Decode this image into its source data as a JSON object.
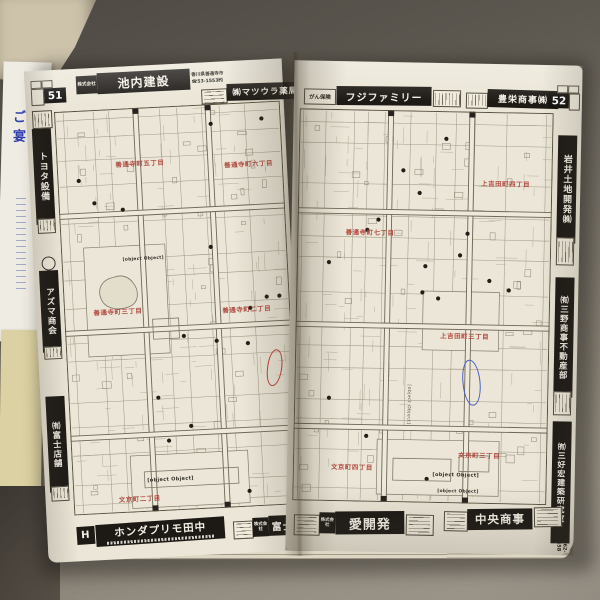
{
  "scene": {
    "paper_note_lines": [
      "ご宴",
      "学生"
    ]
  },
  "left_page": {
    "tab": "51",
    "header": {
      "ad1_logo": "株式会社",
      "ad1_name": "池内建設",
      "ad1_sub1": "香川県善通寺市",
      "ad1_sub2": "☎53-1553㈹",
      "ad2_name": "㈱マツウラ薬局"
    },
    "side_ads": [
      {
        "name": "トヨタ設備"
      },
      {
        "name": "アズマ商会"
      },
      {
        "name": "㈲富士店舗"
      }
    ],
    "footer": {
      "ad1_logo": "H",
      "ad1_name": "ホンダプリモ田中",
      "ad2_prefix": "株式会社",
      "ad2_name": "富士不動産"
    },
    "labels": [
      {
        "text": "善通寺町五丁目"
      },
      {
        "text": "善通寺町六丁目"
      },
      {
        "text": "善通寺町二丁目"
      },
      {
        "text": "善通寺町三丁目"
      },
      {
        "text": "文京町二丁目"
      }
    ],
    "poi_labels": [
      {
        "text": "善通寺市営公園"
      },
      {
        "text": "善通寺市立中央小学校"
      }
    ]
  },
  "right_page": {
    "tab": "52",
    "header": {
      "ad1_note": "がん保険",
      "ad1_name": "フジファミリー",
      "ad2_name": "豊栄商事㈱"
    },
    "side_ads": [
      {
        "name": "岩井土地開発㈱"
      },
      {
        "name": "㈲三野商事不動産部"
      },
      {
        "name": "㈲三好宏建築研究室",
        "sub": "☎62-5558"
      }
    ],
    "footer": {
      "ad1_prefix": "株式会社",
      "ad1_name": "愛開発",
      "ad2_name": "中央商事"
    },
    "labels": [
      {
        "text": "上吉田町四丁目"
      },
      {
        "text": "善通寺町七丁目"
      },
      {
        "text": "上吉田町三丁目"
      },
      {
        "text": "文京町四丁目"
      },
      {
        "text": "文京町三丁目"
      }
    ],
    "poi_labels": [
      {
        "text": "四国学院大学"
      },
      {
        "text": "四国学院短期大学"
      },
      {
        "text": "主要地方道善通寺大野原線"
      }
    ]
  }
}
